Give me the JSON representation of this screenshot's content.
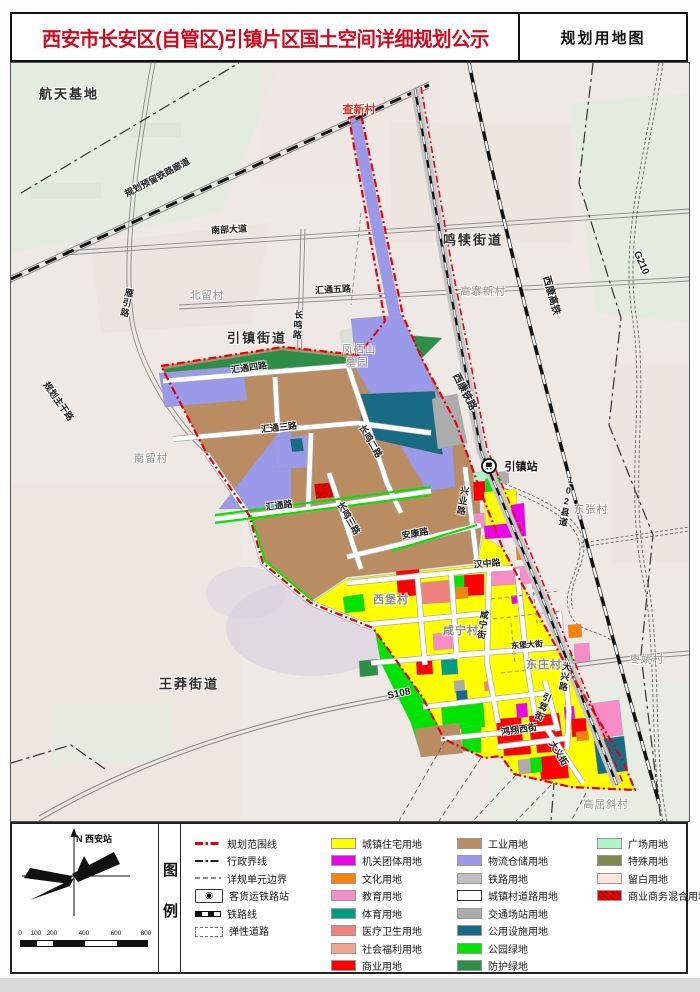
{
  "header": {
    "title": "西安市长安区(自管区)引镇片区国土空间详细规划公示",
    "map_type_label": "规划用地图"
  },
  "legend": {
    "panel_title": "图例",
    "north_label": "N 西安站",
    "scalebar": {
      "ticks": [
        "0",
        "100",
        "200",
        "400",
        "600",
        "800"
      ],
      "unit": "m"
    },
    "line_items": [
      {
        "label": "规划范围线",
        "style": "red-dashdot"
      },
      {
        "label": "行政界线",
        "style": "black-dashdot"
      },
      {
        "label": "详规单元边界",
        "style": "gray-dash"
      },
      {
        "label": "客货运铁路站",
        "style": "rail-station"
      },
      {
        "label": "铁路线",
        "style": "railline"
      },
      {
        "label": "弹性道路",
        "style": "elastic"
      }
    ],
    "landuse_col1": [
      {
        "label": "城镇住宅用地",
        "color": "#FFFF00"
      },
      {
        "label": "机关团体用地",
        "color": "#E805E8"
      },
      {
        "label": "文化用地",
        "color": "#F5820A"
      },
      {
        "label": "教育用地",
        "color": "#F78CC6"
      },
      {
        "label": "体育用地",
        "color": "#009D7E"
      },
      {
        "label": "医疗卫生用地",
        "color": "#F0827D"
      },
      {
        "label": "社会福利用地",
        "color": "#F2A78C"
      },
      {
        "label": "商业用地",
        "color": "#FF0000"
      }
    ],
    "landuse_col2": [
      {
        "label": "工业用地",
        "color": "#BA8C61"
      },
      {
        "label": "物流仓储用地",
        "color": "#9B99E9"
      },
      {
        "label": "铁路用地",
        "color": "#C0C0C0"
      },
      {
        "label": "城镇村道路用地",
        "color": "#FFFFFF",
        "border": true
      },
      {
        "label": "交通场站用地",
        "color": "#ACACAC"
      },
      {
        "label": "公用设施用地",
        "color": "#196A85"
      },
      {
        "label": "公园绿地",
        "color": "#00E400"
      },
      {
        "label": "防护绿地",
        "color": "#2D8F47"
      }
    ],
    "landuse_col3": [
      {
        "label": "广场用地",
        "color": "#ADF6C9"
      },
      {
        "label": "特殊用地",
        "color": "#7C8B4B"
      },
      {
        "label": "留白用地",
        "color": "#FBE7DE"
      },
      {
        "label": "商业商务混合用地",
        "color": "#E60000",
        "hatch": true
      }
    ]
  },
  "map": {
    "labels": [
      {
        "text": "航天基地",
        "x": 58,
        "y": 30,
        "rot": 0,
        "cls": "place-bold"
      },
      {
        "text": "查新村",
        "x": 348,
        "y": 46,
        "rot": 0,
        "cls": "place-red"
      },
      {
        "text": "鸣犊街道",
        "x": 462,
        "y": 176,
        "rot": 0,
        "cls": "place-bold"
      },
      {
        "text": "高寨新村",
        "x": 472,
        "y": 228,
        "rot": 0,
        "cls": "village"
      },
      {
        "text": "北留村",
        "x": 196,
        "y": 232,
        "rot": 0,
        "cls": "village"
      },
      {
        "text": "引镇街道",
        "x": 246,
        "y": 274,
        "rot": 0,
        "cls": "place-bold"
      },
      {
        "text": "凤栖山",
        "x": 348,
        "y": 286,
        "rot": 0,
        "cls": "village"
      },
      {
        "text": "墓园",
        "x": 346,
        "y": 299,
        "rot": 0,
        "cls": "village"
      },
      {
        "text": "南留村",
        "x": 140,
        "y": 395,
        "rot": 0,
        "cls": "village"
      },
      {
        "text": "王莽街道",
        "x": 178,
        "y": 620,
        "rot": 0,
        "cls": "place-bold"
      },
      {
        "text": "东张村",
        "x": 580,
        "y": 446,
        "rot": 0,
        "cls": "village"
      },
      {
        "text": "枣姚村",
        "x": 636,
        "y": 596,
        "rot": 0,
        "cls": "village"
      },
      {
        "text": "高屈斜村",
        "x": 595,
        "y": 741,
        "rot": 0,
        "cls": "village"
      },
      {
        "text": "西堡村",
        "x": 380,
        "y": 536,
        "rot": 0,
        "cls": "village-b"
      },
      {
        "text": "咸宁村",
        "x": 450,
        "y": 567,
        "rot": 0,
        "cls": "village-b"
      },
      {
        "text": "东庄村",
        "x": 533,
        "y": 601,
        "rot": 0,
        "cls": "village-b"
      },
      {
        "text": "引镇站",
        "x": 510,
        "y": 403,
        "rot": 0,
        "cls": "station-label"
      },
      {
        "text": "规划预留铁路廊道",
        "x": 146,
        "y": 114,
        "rot": -28,
        "cls": "road"
      },
      {
        "text": "南部大道",
        "x": 218,
        "y": 166,
        "rot": -3,
        "cls": "road"
      },
      {
        "text": "汇通五路",
        "x": 322,
        "y": 226,
        "rot": -3,
        "cls": "road"
      },
      {
        "text": "雁引路",
        "x": 116,
        "y": 240,
        "rot": 12,
        "cls": "road-v"
      },
      {
        "text": "长鸣路",
        "x": 287,
        "y": 262,
        "rot": 4,
        "cls": "road-v"
      },
      {
        "text": "规划主干路",
        "x": 48,
        "y": 338,
        "rot": 55,
        "cls": "road"
      },
      {
        "text": "汇通四路",
        "x": 238,
        "y": 304,
        "rot": -8,
        "cls": "road"
      },
      {
        "text": "汇通三路",
        "x": 268,
        "y": 364,
        "rot": -6,
        "cls": "road"
      },
      {
        "text": "汇通路",
        "x": 268,
        "y": 442,
        "rot": -7,
        "cls": "road"
      },
      {
        "text": "长鸣二路",
        "x": 360,
        "y": 378,
        "rot": 60,
        "cls": "road"
      },
      {
        "text": "长鸣三路",
        "x": 338,
        "y": 455,
        "rot": 60,
        "cls": "road"
      },
      {
        "text": "安康路",
        "x": 404,
        "y": 470,
        "rot": -10,
        "cls": "road"
      },
      {
        "text": "兴业路",
        "x": 452,
        "y": 438,
        "rot": 10,
        "cls": "road-v"
      },
      {
        "text": "西康铁路",
        "x": 455,
        "y": 328,
        "rot": 63,
        "cls": "road-lg"
      },
      {
        "text": "西康高铁",
        "x": 542,
        "y": 232,
        "rot": 74,
        "cls": "road-lg"
      },
      {
        "text": "G210",
        "x": 630,
        "y": 200,
        "rot": 66,
        "cls": "road-lg"
      },
      {
        "text": "102县道",
        "x": 556,
        "y": 438,
        "rot": 10,
        "cls": "road-v"
      },
      {
        "text": "S108",
        "x": 388,
        "y": 631,
        "rot": -12,
        "cls": "road-lg"
      },
      {
        "text": "汉中路",
        "x": 476,
        "y": 500,
        "rot": -5,
        "cls": "road"
      },
      {
        "text": "咸宁街",
        "x": 472,
        "y": 562,
        "rot": 8,
        "cls": "road-v"
      },
      {
        "text": "东堡大街",
        "x": 516,
        "y": 582,
        "rot": -4,
        "cls": "road-sm"
      },
      {
        "text": "大兴路",
        "x": 554,
        "y": 614,
        "rot": 10,
        "cls": "road-v"
      },
      {
        "text": "引驾街",
        "x": 532,
        "y": 644,
        "rot": 22,
        "cls": "road-v"
      },
      {
        "text": "鸿翔西街",
        "x": 508,
        "y": 666,
        "rot": -8,
        "cls": "road"
      },
      {
        "text": "大义街",
        "x": 548,
        "y": 690,
        "rot": 58,
        "cls": "road"
      }
    ]
  }
}
